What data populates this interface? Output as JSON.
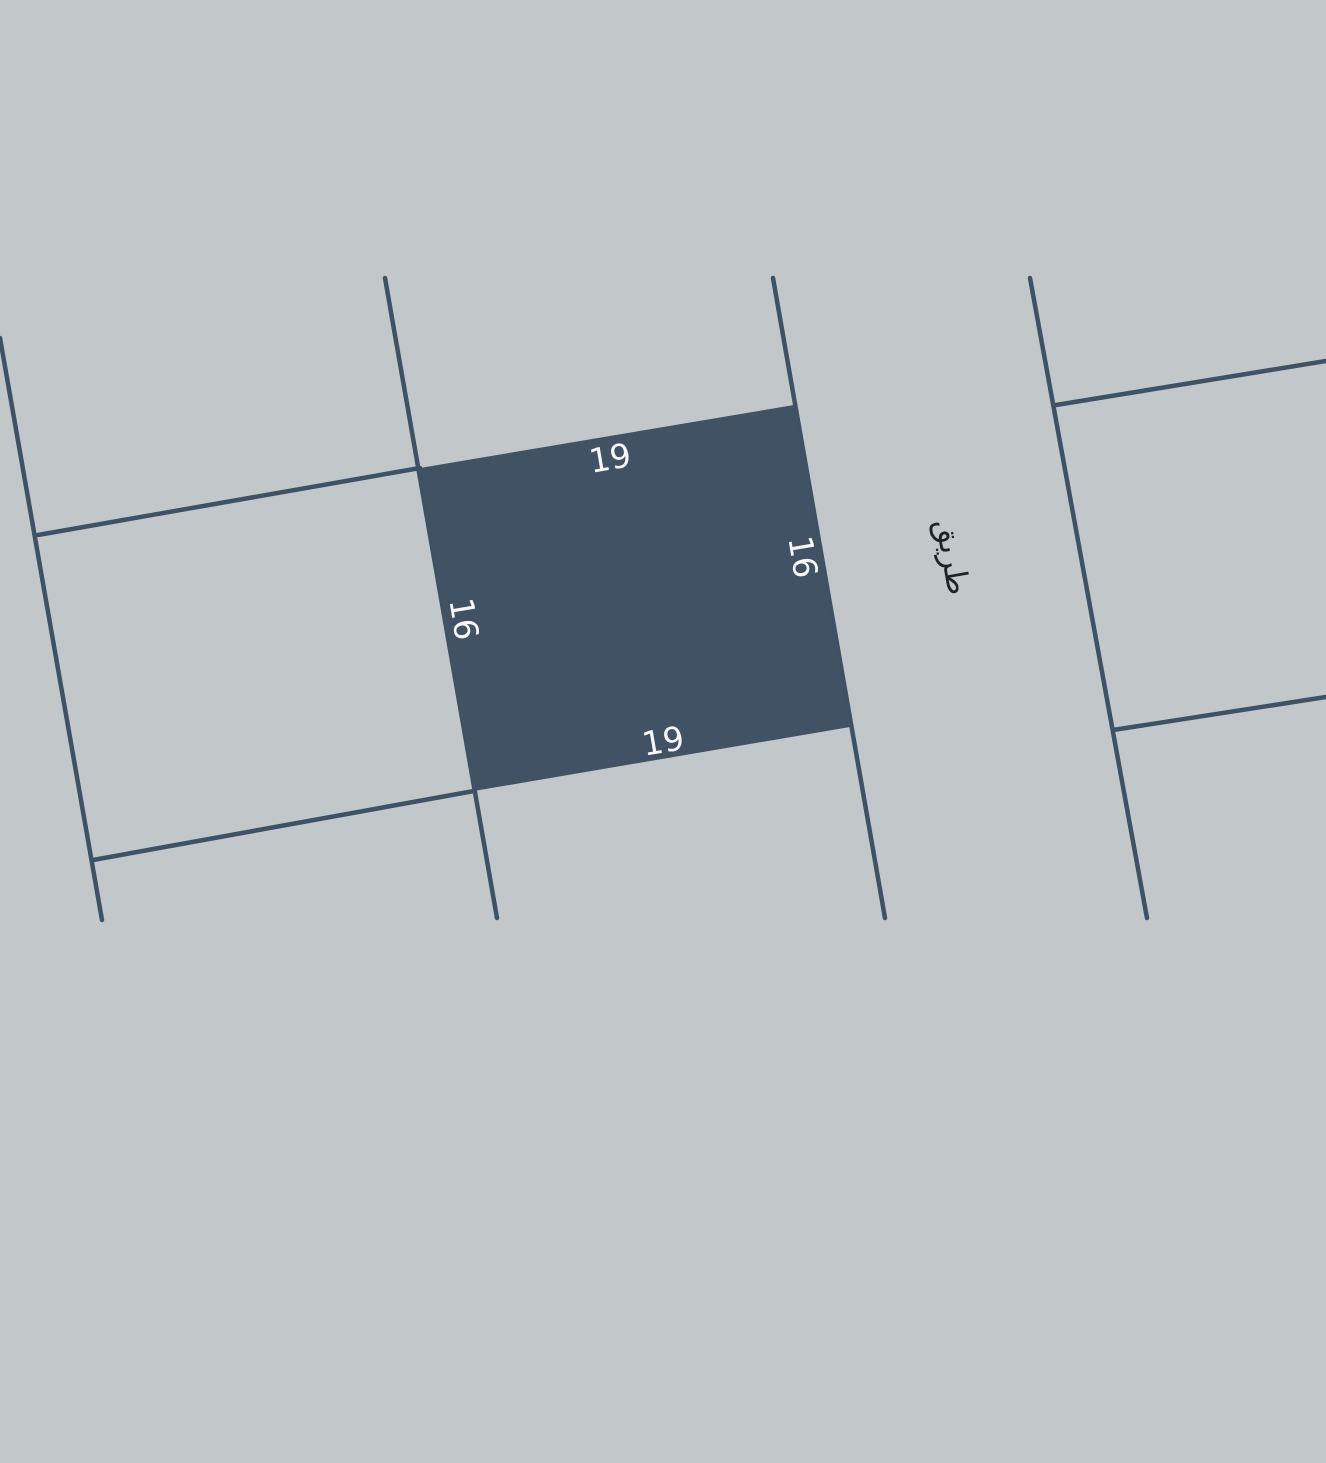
{
  "map": {
    "type": "cadastral-parcel-map",
    "colors": {
      "background": "#c2c7ca",
      "boundary_line": "#3e5265",
      "parcel_fill": "#415264",
      "dimension_label": "#f7f8fa",
      "road_label": "#1d222b"
    },
    "highlighted_parcel": {
      "dim_top": "19",
      "dim_bottom": "19",
      "dim_left": "16",
      "dim_right": "16"
    },
    "road": {
      "label": "طريق"
    }
  }
}
